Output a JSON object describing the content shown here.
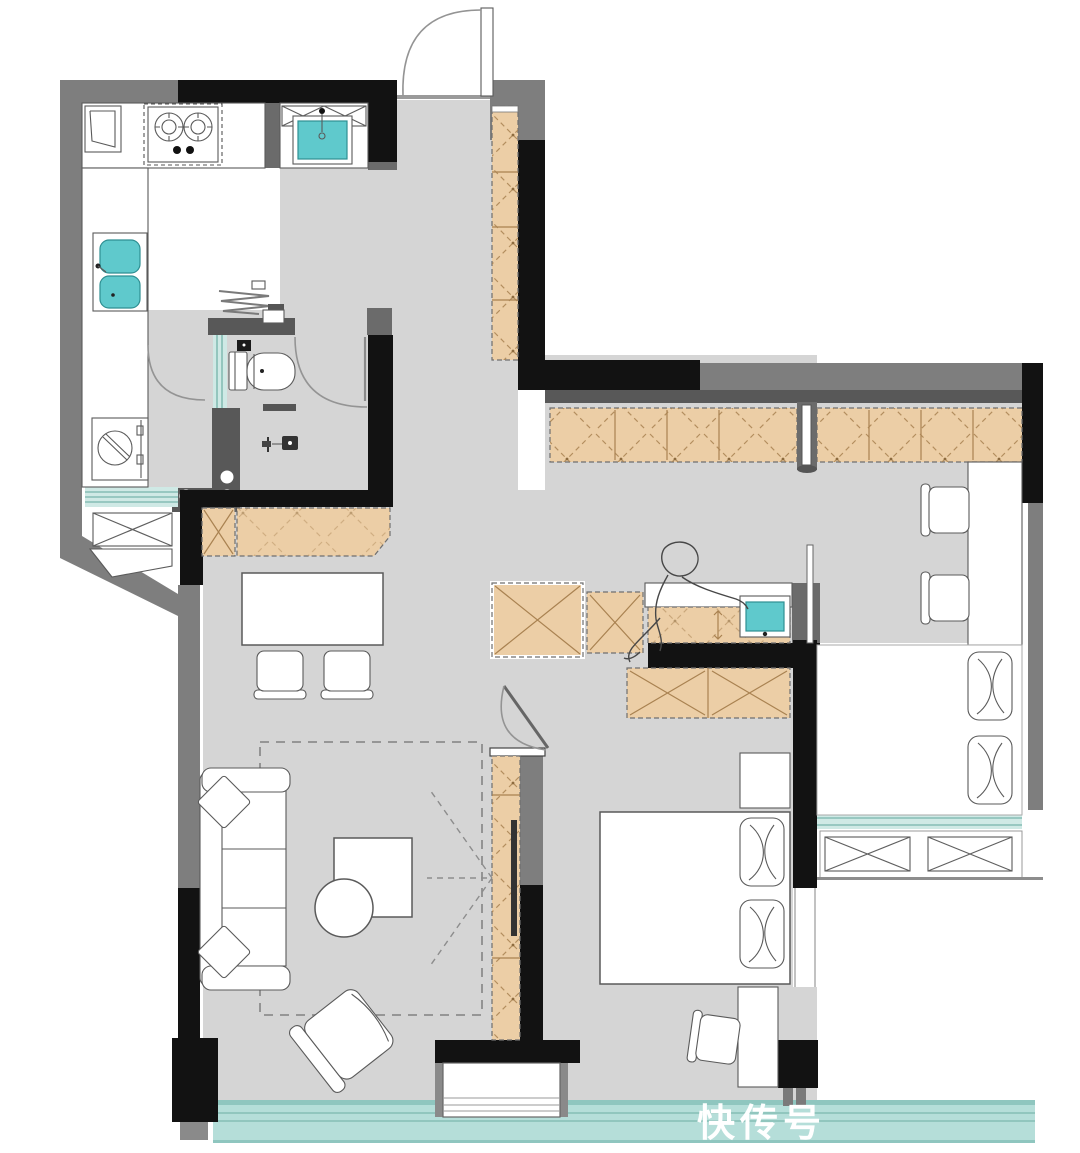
{
  "watermark": {
    "text": "快传号"
  },
  "colors": {
    "floor": "#d5d5d5",
    "wall_black": "#121212",
    "wall_gray": "#7e7e7e",
    "wall_mid": "#6b6b6b",
    "wall_dark": "#585858",
    "tan": "#eccea6",
    "tan_line": "#a98251",
    "teal": "#5fc9cc",
    "teal_deep": "#2e8f92",
    "glass": "#cfe9e5",
    "glass_line": "#85bdb5",
    "balcony": "#b5ded9",
    "balcony_line": "#8fc6bf",
    "line": "#5a5a5a"
  },
  "plan": {
    "type": "apartment-floor-plan",
    "drawn_symbols": [
      "entry-door-with-swing-arc",
      "tall-hall-cabinet",
      "gas-stove-two-burners",
      "range-hood-dashed-outline",
      "kitchen-window",
      "double-basin-kitchen-sink",
      "washing-machine",
      "kitchen-sill-window",
      "entry-wash-basin",
      "toilet",
      "towel-radiator-zigzag",
      "shower-unit",
      "glass-partition",
      "bathroom-door-arc",
      "kitchen-door-arc",
      "dining-table",
      "dining-chairs",
      "sideboard-cabinet",
      "sofa-with-pillows",
      "coffee-table-square-and-round",
      "lounge-armchair",
      "rug-dashed-outline",
      "tv-cabinet-column",
      "projection-cone-dashed",
      "corridor-wardrobe-run",
      "vanity-counter-with-basin",
      "person-sketch",
      "bedroom-wardrobe",
      "double-bed-with-pillows",
      "nightstand",
      "bedroom-desk-and-chair",
      "study-desk",
      "study-chairs",
      "daybed-cushions",
      "window-sill-ac-boxes",
      "balcony-window-band",
      "sliding-door-threshold"
    ]
  }
}
